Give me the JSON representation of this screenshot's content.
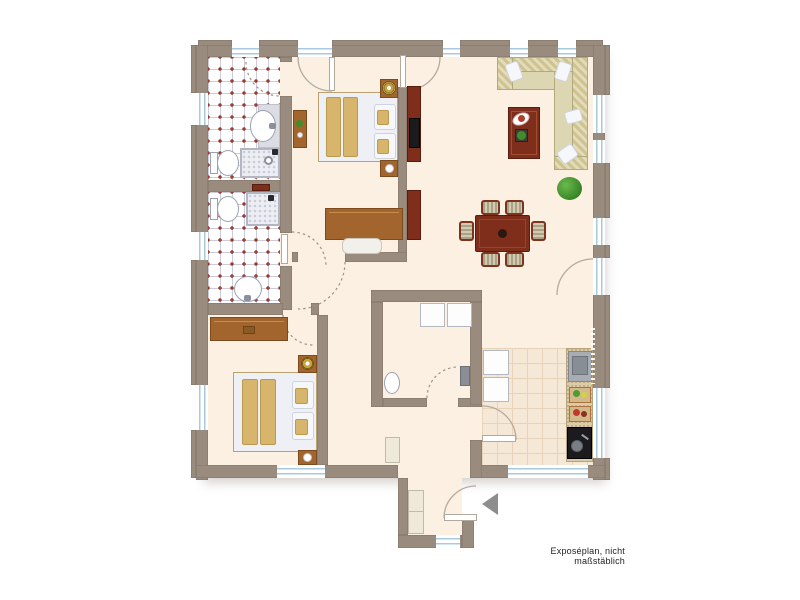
{
  "caption": {
    "text": "Exposéplan, nicht maßstäblich"
  },
  "palette": {
    "wall": "#9a8b7f",
    "floor": "#fbf0e2",
    "tileLine": "#ccccdb",
    "tileDot": "#993b2e",
    "kitchenTileBg": "#f6e8d7",
    "kitchenTileLine": "#e6d3ba",
    "windowBlue": "#a9c9de",
    "arcSolid": "#b3aaa0",
    "arcDashed": "#9b9389",
    "woodMid": "#a2652d",
    "woodDark": "#7c4a1c",
    "redwood": "#7e2e1b",
    "redwoodDark": "#591d0f",
    "blanket": "#d8b56c",
    "linen": "#eef0f5",
    "sofaBase": "#ddd6b2",
    "sofaPattern": "#cfc391",
    "chairStripeA": "#a9a28a",
    "chairStripeB": "#d2cbae",
    "green": "#3f8d2b",
    "arrow": "#8d8d8d",
    "counter": "#dbcba9",
    "black": "#1b1b1f",
    "textColor": "#222222"
  },
  "plan": {
    "type": "apartment-floor-plan",
    "rooms": [
      "bathroom-top",
      "bathroom-middle",
      "bedroom-top",
      "living-dining-room",
      "bedroom-bottom",
      "hallway",
      "storage-wc",
      "kitchen",
      "entrance-vestibule"
    ],
    "furniture": [
      "double-bed-top",
      "double-bed-bottom",
      "nightstands-with-lamps",
      "desk-with-bench",
      "wall-shelf",
      "corner-sofa",
      "coffee-table",
      "tv-sideboard",
      "dining-table",
      "six-dining-chairs",
      "potted-plant",
      "sideboard",
      "washer-dryer-boxes",
      "wash-basins",
      "toilets",
      "showers",
      "fridge",
      "kitchen-counter",
      "kitchen-sink",
      "cutting-boards",
      "stove",
      "hall-cabinets",
      "entrance-arrow"
    ],
    "watermark_legible": false
  }
}
